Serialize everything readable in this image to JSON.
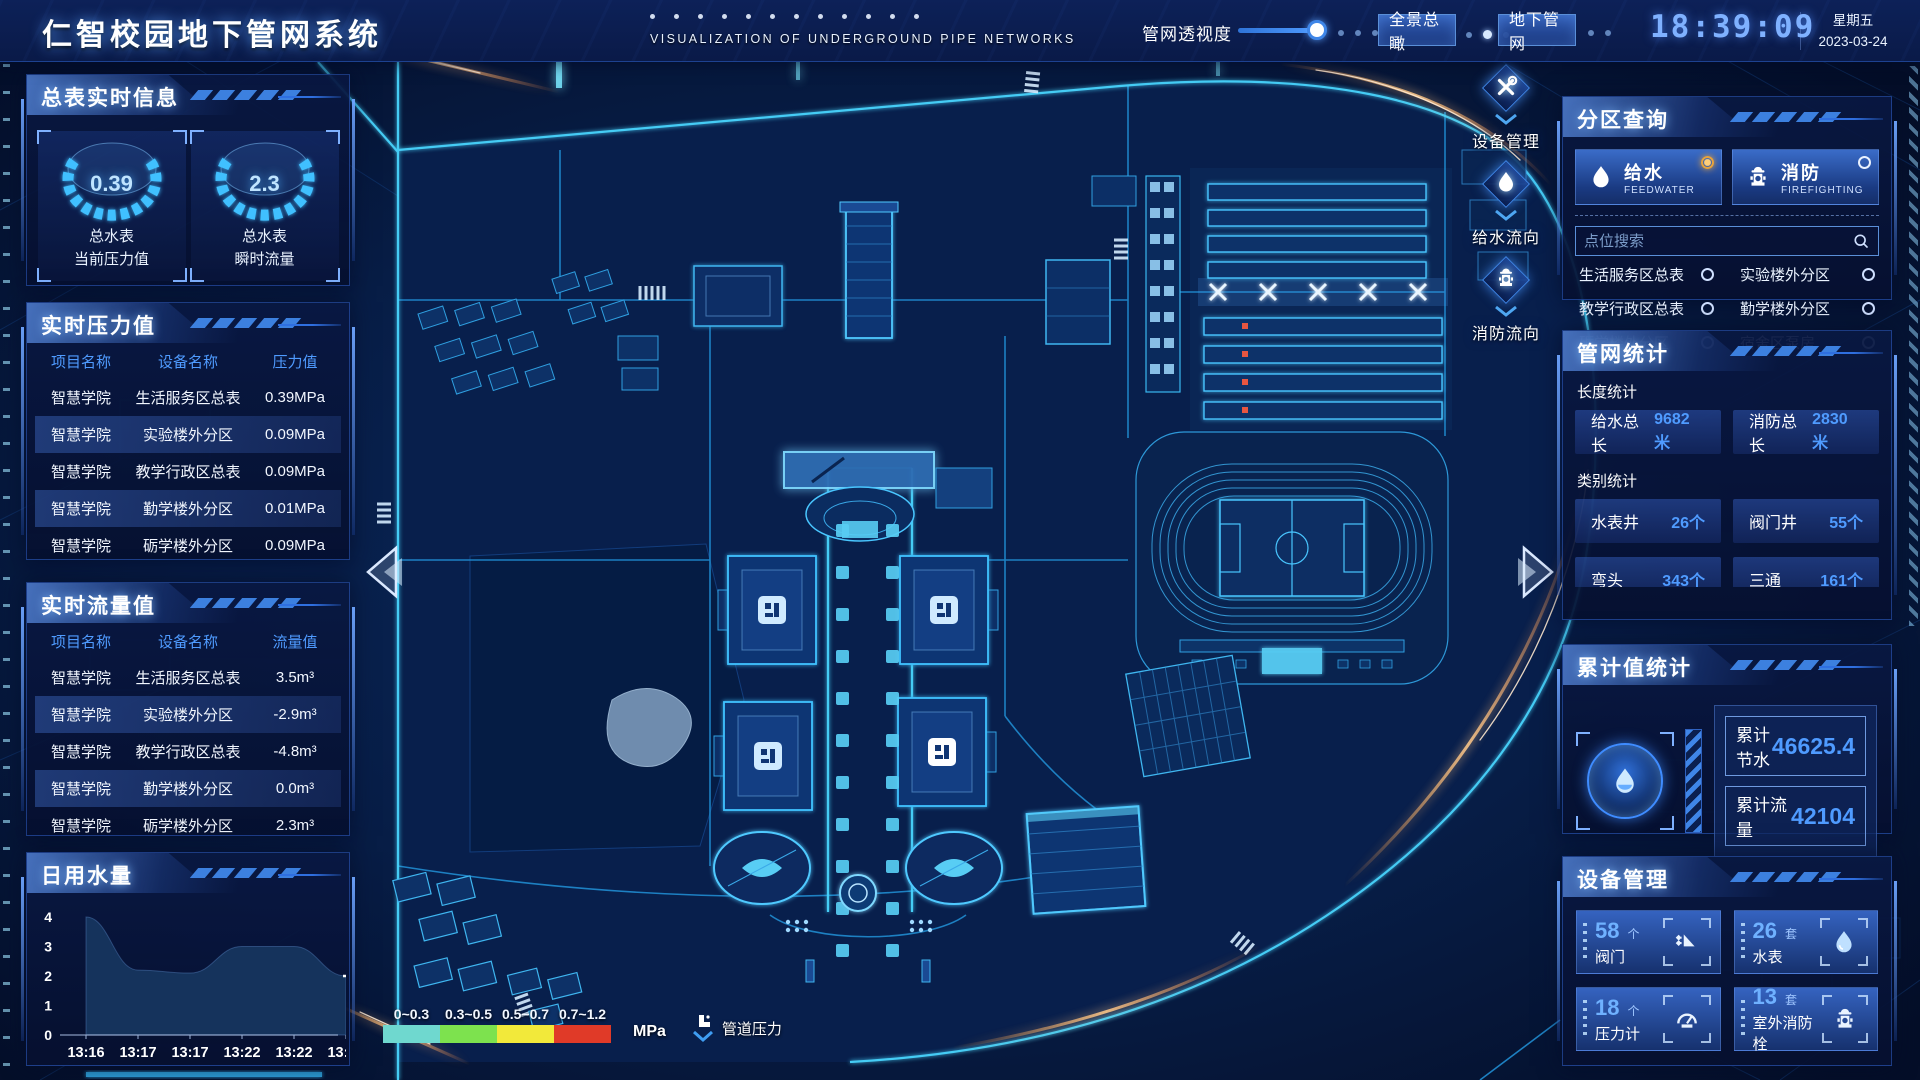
{
  "header": {
    "title": "仁智校园地下管网系统",
    "subtitle": "VISUALIZATION OF UNDERGROUND PIPE NETWORKS",
    "slider": {
      "label": "管网透视度",
      "value_pct": 92
    },
    "buttons": [
      {
        "label": "全景总瞰"
      },
      {
        "label": "地下管网"
      }
    ],
    "clock": {
      "time": "18:39:09",
      "weekday": "星期五",
      "date": "2023-03-24"
    }
  },
  "left": {
    "meter_info": {
      "title": "总表实时信息",
      "gauges": [
        {
          "value": "0.39",
          "line1": "总水表",
          "line2": "当前压力值"
        },
        {
          "value": "2.3",
          "line1": "总水表",
          "line2": "瞬时流量"
        }
      ]
    },
    "pressure": {
      "title": "实时压力值",
      "columns": [
        "项目名称",
        "设备名称",
        "压力值"
      ],
      "rows": [
        [
          "智慧学院",
          "生活服务区总表",
          "0.39MPa"
        ],
        [
          "智慧学院",
          "实验楼外分区",
          "0.09MPa"
        ],
        [
          "智慧学院",
          "教学行政区总表",
          "0.09MPa"
        ],
        [
          "智慧学院",
          "勤学楼外分区",
          "0.01MPa"
        ],
        [
          "智慧学院",
          "砺学楼外分区",
          "0.09MPa"
        ]
      ]
    },
    "flow": {
      "title": "实时流量值",
      "columns": [
        "项目名称",
        "设备名称",
        "流量值"
      ],
      "rows": [
        [
          "智慧学院",
          "生活服务区总表",
          "3.5m³"
        ],
        [
          "智慧学院",
          "实验楼外分区",
          "-2.9m³"
        ],
        [
          "智慧学院",
          "教学行政区总表",
          "-4.8m³"
        ],
        [
          "智慧学院",
          "勤学楼外分区",
          "0.0m³"
        ],
        [
          "智慧学院",
          "砺学楼外分区",
          "2.3m³"
        ]
      ]
    },
    "daily_water": {
      "title": "日用水量",
      "chart": {
        "type": "area",
        "x": [
          "13:16",
          "13:17",
          "13:17",
          "13:22",
          "13:22",
          "13:23"
        ],
        "values": [
          4,
          2.2,
          2.1,
          3,
          3,
          2
        ],
        "yticks": [
          0,
          1,
          2,
          3,
          4
        ],
        "ylim": [
          0,
          4
        ],
        "end_label": "2",
        "area_color": "#16355f",
        "end_label_color": "#d9a62e"
      }
    }
  },
  "map": {
    "tools": [
      {
        "label": "设备管理",
        "icon": "wrench-icon"
      },
      {
        "label": "给水流向",
        "icon": "water-drop-icon"
      },
      {
        "label": "消防流向",
        "icon": "hydrant-icon"
      }
    ],
    "legend": {
      "ranges": [
        {
          "label": "0~0.3",
          "color": "#6fd8cf"
        },
        {
          "label": "0.3~0.5",
          "color": "#7de24e"
        },
        {
          "label": "0.5~0.7",
          "color": "#f2e93a"
        },
        {
          "label": "0.7~1.2",
          "color": "#e03a28"
        }
      ],
      "unit": "MPa",
      "flow_label": "管道压力"
    }
  },
  "right": {
    "zone_query": {
      "title": "分区查询",
      "tabs": [
        {
          "label": "给水",
          "sub": "FEEDWATER",
          "selected": true
        },
        {
          "label": "消防",
          "sub": "FIREFIGHTING",
          "selected": false
        }
      ],
      "search_placeholder": "点位搜索",
      "items": [
        "生活服务区总表",
        "实验楼外分区",
        "教学行政区总表",
        "勤学楼外分区",
        "砺学楼外分区",
        "宿舍区泵房"
      ]
    },
    "pipe_stats": {
      "title": "管网统计",
      "length_label": "长度统计",
      "length_stats": [
        {
          "label": "给水总长",
          "value": "9682米"
        },
        {
          "label": "消防总长",
          "value": "2830米"
        }
      ],
      "category_label": "类别统计",
      "category_stats": [
        {
          "label": "水表井",
          "value": "26个"
        },
        {
          "label": "阀门井",
          "value": "55个"
        },
        {
          "label": "弯头",
          "value": "343个"
        },
        {
          "label": "三通",
          "value": "161个"
        }
      ]
    },
    "cumulative": {
      "title": "累计值统计",
      "rows": [
        {
          "label": "累计节水",
          "value": "46625.4"
        },
        {
          "label": "累计流量",
          "value": "42104"
        }
      ]
    },
    "devices": {
      "title": "设备管理",
      "cards": [
        {
          "count": "58",
          "unit": "个",
          "label": "阀门",
          "icon": "valve-icon"
        },
        {
          "count": "26",
          "unit": "套",
          "label": "水表",
          "icon": "water-drop-icon"
        },
        {
          "count": "18",
          "unit": "个",
          "label": "压力计",
          "icon": "pressure-gauge-icon"
        },
        {
          "count": "13",
          "unit": "套",
          "label": "室外消防栓",
          "icon": "hydrant-icon"
        }
      ]
    }
  }
}
